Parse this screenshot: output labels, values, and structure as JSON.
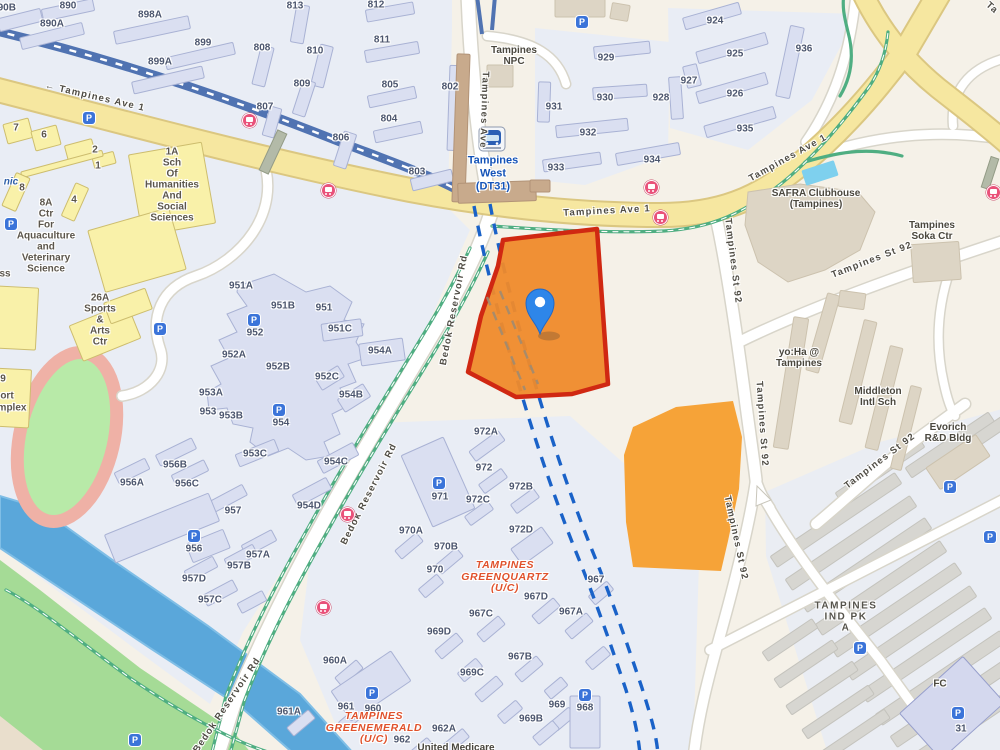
{
  "map": {
    "area_name": "Tampines West",
    "colors": {
      "selected_site_border": "#D02812",
      "selected_site_fill": "#EF8A2B",
      "secondary_site_fill": "#F6A338",
      "pin_blue": "#2E86E9",
      "major_road_yellow": "#F6E7A0",
      "water_blue": "#5AA7DA",
      "park_green": "#A5DB96",
      "mrt_viaduct_blue": "#5073B2",
      "boundary_dash_blue": "#1A62C8",
      "bus_icon_pink": "#E9527A",
      "parking_icon_blue": "#3B74D9",
      "construction_label_orange": "#E0512B",
      "station_label_blue": "#1453B8"
    },
    "labels": {
      "roads": [
        {
          "t": "← Tampines Ave 1",
          "x": 95,
          "y": 97,
          "r": 13
        },
        {
          "t": "Tampines Ave 1",
          "x": 607,
          "y": 211,
          "r": -3
        },
        {
          "t": "Tampines Ave 1",
          "x": 788,
          "y": 158,
          "r": -29
        },
        {
          "t": "Tampines Ave",
          "x": 484,
          "y": 110,
          "r": 92
        },
        {
          "t": "Ta",
          "x": 992,
          "y": 8,
          "r": 42
        },
        {
          "t": "Bedok Reservoir Rd",
          "x": 454,
          "y": 310,
          "r": -79
        },
        {
          "t": "Bedok Reservoir Rd",
          "x": 369,
          "y": 494,
          "r": -63
        },
        {
          "t": "Bedok Reservoir Rd",
          "x": 227,
          "y": 705,
          "r": -56
        },
        {
          "t": "Tampines St 92",
          "x": 733,
          "y": 261,
          "r": 83
        },
        {
          "t": "Tampines St 92",
          "x": 762,
          "y": 424,
          "r": 86
        },
        {
          "t": "Tampines St 92",
          "x": 736,
          "y": 538,
          "r": 78
        },
        {
          "t": "Tampines St 92",
          "x": 872,
          "y": 260,
          "r": -21
        },
        {
          "t": "Tampines St 92",
          "x": 880,
          "y": 461,
          "r": -37
        }
      ],
      "blocks": [
        {
          "t": "890B",
          "x": 4,
          "y": 8
        },
        {
          "t": "890",
          "x": 68,
          "y": 6
        },
        {
          "t": "890A",
          "x": 52,
          "y": 24
        },
        {
          "t": "898A",
          "x": 150,
          "y": 15
        },
        {
          "t": "899",
          "x": 203,
          "y": 43
        },
        {
          "t": "899A",
          "x": 160,
          "y": 62
        },
        {
          "t": "808",
          "x": 262,
          "y": 48
        },
        {
          "t": "810",
          "x": 315,
          "y": 51
        },
        {
          "t": "813",
          "x": 295,
          "y": 6
        },
        {
          "t": "809",
          "x": 302,
          "y": 84
        },
        {
          "t": "807",
          "x": 265,
          "y": 107
        },
        {
          "t": "806",
          "x": 341,
          "y": 138
        },
        {
          "t": "812",
          "x": 376,
          "y": 5
        },
        {
          "t": "811",
          "x": 382,
          "y": 40
        },
        {
          "t": "805",
          "x": 390,
          "y": 85
        },
        {
          "t": "802",
          "x": 450,
          "y": 87
        },
        {
          "t": "804",
          "x": 389,
          "y": 119
        },
        {
          "t": "803",
          "x": 417,
          "y": 172
        },
        {
          "t": "929",
          "x": 606,
          "y": 58
        },
        {
          "t": "930",
          "x": 605,
          "y": 98
        },
        {
          "t": "931",
          "x": 554,
          "y": 107
        },
        {
          "t": "928",
          "x": 661,
          "y": 98
        },
        {
          "t": "932",
          "x": 588,
          "y": 133
        },
        {
          "t": "933",
          "x": 556,
          "y": 168
        },
        {
          "t": "934",
          "x": 652,
          "y": 160
        },
        {
          "t": "924",
          "x": 715,
          "y": 21
        },
        {
          "t": "925",
          "x": 735,
          "y": 54
        },
        {
          "t": "926",
          "x": 735,
          "y": 94
        },
        {
          "t": "927",
          "x": 689,
          "y": 81
        },
        {
          "t": "935",
          "x": 745,
          "y": 129
        },
        {
          "t": "936",
          "x": 804,
          "y": 49
        },
        {
          "t": "951A",
          "x": 241,
          "y": 286
        },
        {
          "t": "951B",
          "x": 283,
          "y": 306
        },
        {
          "t": "951",
          "x": 324,
          "y": 308
        },
        {
          "t": "951C",
          "x": 340,
          "y": 329
        },
        {
          "t": "952",
          "x": 255,
          "y": 333
        },
        {
          "t": "952A",
          "x": 234,
          "y": 355
        },
        {
          "t": "952B",
          "x": 278,
          "y": 367
        },
        {
          "t": "952C",
          "x": 327,
          "y": 377
        },
        {
          "t": "954A",
          "x": 380,
          "y": 351
        },
        {
          "t": "953A",
          "x": 211,
          "y": 393
        },
        {
          "t": "953",
          "x": 208,
          "y": 412
        },
        {
          "t": "953B",
          "x": 231,
          "y": 416
        },
        {
          "t": "954B",
          "x": 351,
          "y": 395
        },
        {
          "t": "954",
          "x": 281,
          "y": 423
        },
        {
          "t": "953C",
          "x": 255,
          "y": 454
        },
        {
          "t": "954C",
          "x": 336,
          "y": 462
        },
        {
          "t": "954D",
          "x": 309,
          "y": 506
        },
        {
          "t": "956B",
          "x": 175,
          "y": 465
        },
        {
          "t": "956A",
          "x": 132,
          "y": 483
        },
        {
          "t": "956C",
          "x": 187,
          "y": 484
        },
        {
          "t": "957",
          "x": 233,
          "y": 511
        },
        {
          "t": "956",
          "x": 194,
          "y": 549
        },
        {
          "t": "957A",
          "x": 258,
          "y": 555
        },
        {
          "t": "957B",
          "x": 239,
          "y": 566
        },
        {
          "t": "957D",
          "x": 194,
          "y": 579
        },
        {
          "t": "957C",
          "x": 210,
          "y": 600
        },
        {
          "t": "971",
          "x": 440,
          "y": 497
        },
        {
          "t": "972A",
          "x": 486,
          "y": 432
        },
        {
          "t": "972",
          "x": 484,
          "y": 468
        },
        {
          "t": "972B",
          "x": 521,
          "y": 487
        },
        {
          "t": "972C",
          "x": 478,
          "y": 500
        },
        {
          "t": "972D",
          "x": 521,
          "y": 530
        },
        {
          "t": "970A",
          "x": 411,
          "y": 531
        },
        {
          "t": "970B",
          "x": 446,
          "y": 547
        },
        {
          "t": "970",
          "x": 435,
          "y": 570
        },
        {
          "t": "967",
          "x": 596,
          "y": 580
        },
        {
          "t": "967D",
          "x": 536,
          "y": 597
        },
        {
          "t": "967C",
          "x": 481,
          "y": 614
        },
        {
          "t": "967A",
          "x": 571,
          "y": 612
        },
        {
          "t": "969D",
          "x": 439,
          "y": 632
        },
        {
          "t": "967B",
          "x": 520,
          "y": 657
        },
        {
          "t": "969C",
          "x": 472,
          "y": 673
        },
        {
          "t": "960A",
          "x": 335,
          "y": 661
        },
        {
          "t": "961",
          "x": 346,
          "y": 707
        },
        {
          "t": "960",
          "x": 373,
          "y": 709
        },
        {
          "t": "961A",
          "x": 289,
          "y": 712
        },
        {
          "t": "962A",
          "x": 444,
          "y": 729
        },
        {
          "t": "962",
          "x": 402,
          "y": 740
        },
        {
          "t": "969",
          "x": 557,
          "y": 705
        },
        {
          "t": "969B",
          "x": 531,
          "y": 719
        },
        {
          "t": "968",
          "x": 585,
          "y": 708
        },
        {
          "t": "31",
          "x": 961,
          "y": 729
        }
      ],
      "campus_numbers": [
        {
          "t": "7",
          "x": 16,
          "y": 128
        },
        {
          "t": "6",
          "x": 44,
          "y": 135
        },
        {
          "t": "2",
          "x": 95,
          "y": 150
        },
        {
          "t": "1",
          "x": 98,
          "y": 166
        },
        {
          "t": "8",
          "x": 22,
          "y": 188
        },
        {
          "t": "4",
          "x": 74,
          "y": 200
        },
        {
          "t": "9",
          "x": 3,
          "y": 379
        },
        {
          "t": "ort",
          "x": 7,
          "y": 396
        },
        {
          "t": "mplex",
          "x": 12,
          "y": 408
        },
        {
          "t": "ss",
          "x": 5,
          "y": 274
        }
      ],
      "fragments": [
        {
          "t": "nic",
          "x": 11,
          "y": 182
        }
      ],
      "places": [
        {
          "cls": "p",
          "lines": [
            "Tampines",
            "NPC"
          ],
          "x": 514,
          "y": 56
        },
        {
          "cls": "stn",
          "lines": [
            "Tampines",
            "West",
            "(DT31)"
          ],
          "x": 493,
          "y": 174
        },
        {
          "cls": "p",
          "lines": [
            "SAFRA Clubhouse",
            "(Tampines)"
          ],
          "x": 816,
          "y": 199
        },
        {
          "cls": "p",
          "lines": [
            "Tampines",
            "Soka Ctr"
          ],
          "x": 932,
          "y": 231
        },
        {
          "cls": "p",
          "lines": [
            "yo:Ha @",
            "Tampines"
          ],
          "x": 799,
          "y": 358
        },
        {
          "cls": "p",
          "lines": [
            "Middleton",
            "Intl Sch"
          ],
          "x": 878,
          "y": 397
        },
        {
          "cls": "p",
          "lines": [
            "Evorich",
            "R&D Bldg"
          ],
          "x": 948,
          "y": 433
        },
        {
          "cls": "uc",
          "lines": [
            "TAMPINES",
            "GREENQUARTZ",
            "(U/C)"
          ],
          "x": 505,
          "y": 577
        },
        {
          "cls": "uc",
          "lines": [
            "TAMPINES",
            "GREENEMERALD",
            "(U/C)"
          ],
          "x": 374,
          "y": 728
        },
        {
          "cls": "pw",
          "lines": [
            "TAMPINES",
            "IND PK",
            "A"
          ],
          "x": 846,
          "y": 617
        },
        {
          "cls": "p",
          "lines": [
            "United Medicare"
          ],
          "x": 456,
          "y": 748
        },
        {
          "cls": "p",
          "lines": [
            "FC"
          ],
          "x": 940,
          "y": 684
        },
        {
          "cls": "y",
          "lines": [
            "1A",
            "Sch",
            "Of",
            "Humanities",
            "And",
            "Social",
            "Sciences"
          ],
          "x": 172,
          "y": 185
        },
        {
          "cls": "y",
          "lines": [
            "8A",
            "Ctr",
            "For",
            "Aquaculture",
            "and",
            "Veterinary",
            "Science"
          ],
          "x": 46,
          "y": 236
        },
        {
          "cls": "y",
          "lines": [
            "26A",
            "Sports",
            "&",
            "Arts",
            "Ctr"
          ],
          "x": 100,
          "y": 320
        }
      ]
    },
    "icons": {
      "parking_glyph": "P",
      "parking": [
        [
          89,
          118
        ],
        [
          582,
          22
        ],
        [
          11,
          224
        ],
        [
          160,
          329
        ],
        [
          254,
          320
        ],
        [
          279,
          410
        ],
        [
          194,
          536
        ],
        [
          439,
          483
        ],
        [
          372,
          693
        ],
        [
          585,
          695
        ],
        [
          135,
          740
        ],
        [
          950,
          487
        ],
        [
          990,
          537
        ],
        [
          860,
          648
        ],
        [
          958,
          713
        ]
      ],
      "bus_stops": [
        [
          249,
          120
        ],
        [
          328,
          190
        ],
        [
          651,
          187
        ],
        [
          660,
          217
        ],
        [
          347,
          514
        ],
        [
          323,
          607
        ],
        [
          993,
          192
        ]
      ],
      "train_station": {
        "x": 492,
        "y": 139
      }
    },
    "pin": {
      "x": 540,
      "y": 296
    }
  }
}
